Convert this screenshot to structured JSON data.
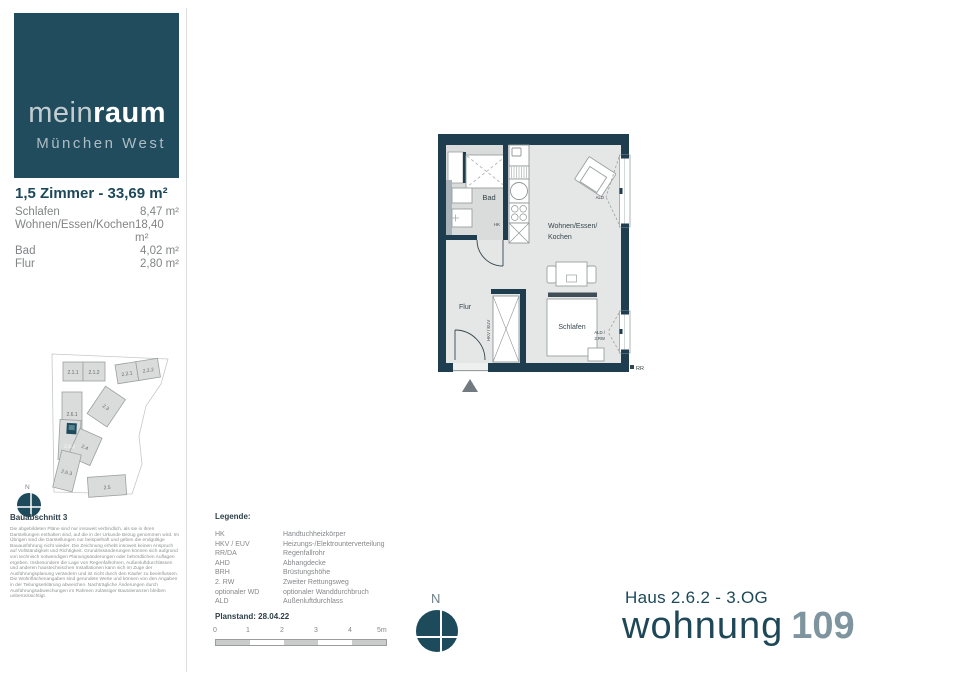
{
  "brand": {
    "name_light": "mein",
    "name_bold": "raum",
    "subtitle": "München West"
  },
  "unit": {
    "title": "1,5 Zimmer - 33,69 m²",
    "rooms": [
      {
        "name": "Schlafen",
        "area": "8,47 m²"
      },
      {
        "name": "Wohnen/Essen/Kochen",
        "area": "18,40 m²"
      },
      {
        "name": "Bad",
        "area": "4,02 m²"
      },
      {
        "name": "Flur",
        "area": "2,80 m²"
      }
    ]
  },
  "site_plan": {
    "heading": "Bauabschnitt 3",
    "north_label": "N",
    "buildings": [
      "2.1.1",
      "2.1.2",
      "2.2.1",
      "2.2.2",
      "2.6.1",
      "2.6.2",
      "2.3",
      "2.4",
      "2.6.3",
      "2.5"
    ],
    "disclaimer": "Die abgebildeten Pläne sind nur insoweit verbindlich, als sie in ihren Darstellungen enthalten sind, auf die in der Urkunde Bezug genommen wird. Im Übrigen sind die Darstellungen nur beispielhaft und geben die endgültige Bauausführung nicht wieder. Die Zeichnung erhebt insoweit keinen Anspruch auf Vollständigkeit und Richtigkeit. Grundrissänderungen können sich aufgrund von technisch notwendigen Planungsänderungen oder behördlichen Auflagen ergeben. Insbesondere die Lage von Regenfallrohren, Außenluftdurchlässen und anderen haustechnischen Installationen kann sich im Zuge der Ausführungsplanung verändern und ist nicht durch den Käufer zu beeinflussen. Die Wohnflächenangaben sind gerundete Werte und können von den Angaben in der Teilungserklärung abweichen. Nachträgliche Änderungen durch Ausführungsabweichungen im Rahmen zulässiger Bautoleranzen bleiben unberücksichtigt."
  },
  "floor_plan": {
    "rooms": {
      "bad": "Bad",
      "flur": "Flur",
      "wohnen_line1": "Wohnen/Essen/",
      "wohnen_line2": "Kochen",
      "schlafen": "Schlafen"
    },
    "annotations": {
      "hk": "HK",
      "hkv_euv": "HKV / EUV",
      "ald": "ALD",
      "ald_rw_line1": "ALD /",
      "ald_rw_line2": "2.RW",
      "rr": "RR"
    }
  },
  "legend": {
    "heading": "Legende:",
    "entries": [
      {
        "abbr": "HK",
        "desc": "Handtuchheizkörper"
      },
      {
        "abbr": "HKV / EUV",
        "desc": "Heizungs-/Elektrounterverteilung"
      },
      {
        "abbr": "RR/DA",
        "desc": "Regenfallrohr"
      },
      {
        "abbr": "AHD",
        "desc": "Abhangdecke"
      },
      {
        "abbr": "BRH",
        "desc": "Brüstungshöhe"
      },
      {
        "abbr": "2. RW",
        "desc": "Zweiter Rettungsweg"
      },
      {
        "abbr": "optionaler WD",
        "desc": "optionaler Wanddurchbruch"
      },
      {
        "abbr": "ALD",
        "desc": "Außenluftdurchlass"
      }
    ]
  },
  "plan_meta": {
    "planstand": "Planstand: 28.04.22",
    "scale_ticks": [
      "0",
      "1",
      "2",
      "3",
      "4",
      "5m"
    ],
    "north_label": "N"
  },
  "unit_title": {
    "haus": "Haus 2.6.2 - 3.OG",
    "wohnung_label": "wohnung",
    "wohnung_number": "109"
  },
  "colors": {
    "brand_teal": "#214c5e",
    "wall": "#1e3d4f",
    "accent_gray_blue": "#7e949e",
    "floor": "#e5e7e6",
    "bad_floor": "#d9dcda"
  }
}
